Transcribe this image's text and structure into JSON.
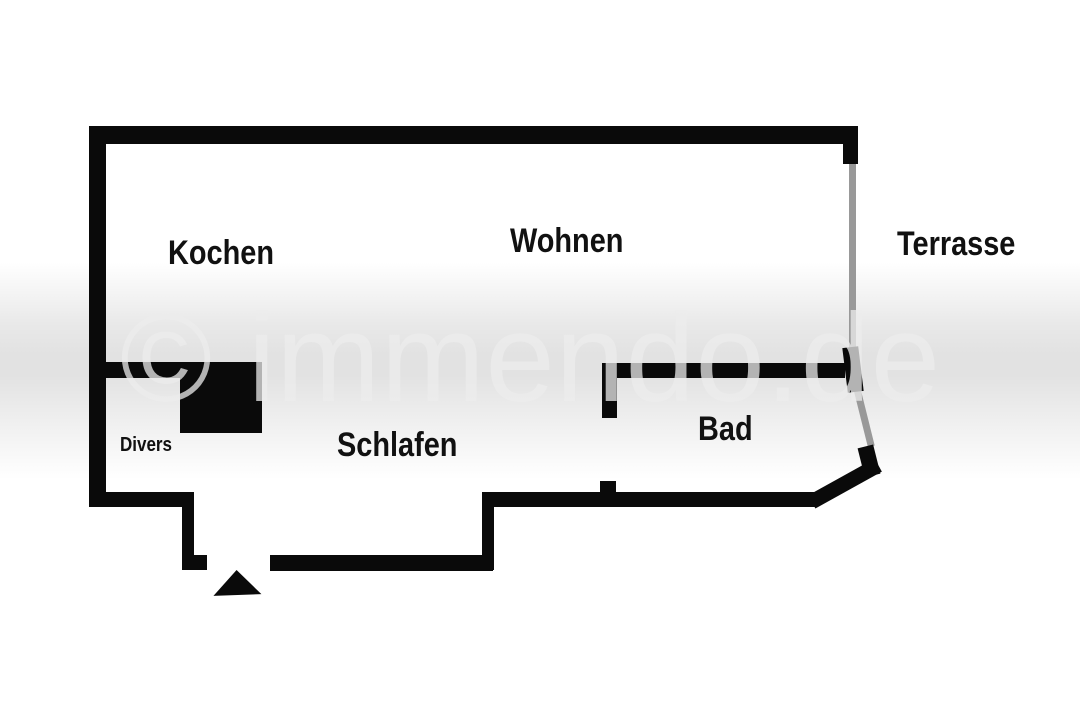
{
  "watermark": {
    "text": "© immendo.de"
  },
  "rooms": {
    "kochen": {
      "label": "Kochen"
    },
    "wohnen": {
      "label": "Wohnen"
    },
    "terrasse": {
      "label": "Terrasse"
    },
    "schlafen": {
      "label": "Schlafen"
    },
    "bad": {
      "label": "Bad"
    },
    "divers": {
      "label": "Divers"
    }
  },
  "colors": {
    "wall": "#0a0a0a",
    "window": "#999999",
    "label_text": "#111111",
    "watermark_text": "rgba(236,236,236,0.75)",
    "background": "#ffffff"
  }
}
